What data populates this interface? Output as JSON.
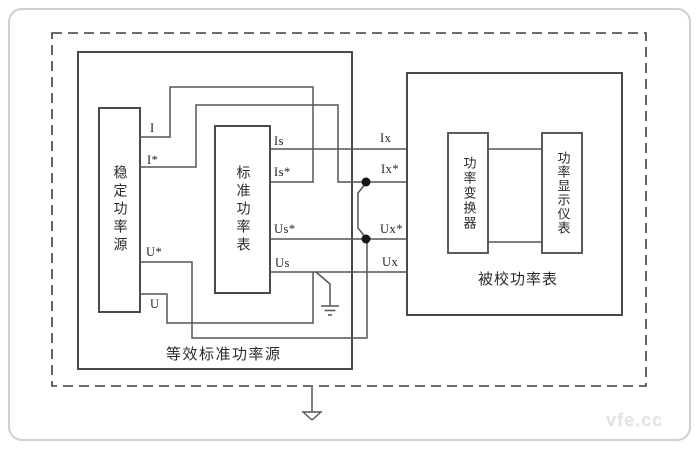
{
  "diagram": {
    "blocks": {
      "equivalent_standard_source": "等效标准功率源",
      "stable_power_source": "稳定功率源",
      "standard_power_meter": "标准功率表",
      "tested_power_meter": "被校功率表",
      "power_converter": "功率变换器",
      "power_display_instrument": "功率显示仪表"
    },
    "terminals": {
      "i": "I",
      "i_star": "I*",
      "u_star": "U*",
      "u": "U",
      "is": "Is",
      "is_star": "Is*",
      "us_star": "Us*",
      "us": "Us",
      "ix": "Ix",
      "ix_star": "Ix*",
      "ux_star": "Ux*",
      "ux": "Ux"
    },
    "watermark": "vfe.cc",
    "colors": {
      "wire": "#555555",
      "box_border": "#4a4a4a",
      "dashed_border": "#3d3d3d",
      "junction_dot": "#161616",
      "text": "#2b2b2b",
      "watermark": "#e3e3e3",
      "frame_border": "#cfcfcf"
    }
  }
}
